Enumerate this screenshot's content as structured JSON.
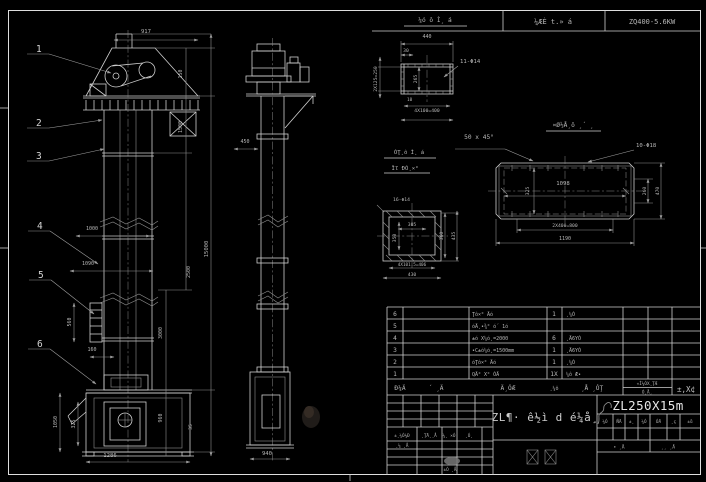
{
  "colors": {
    "background": "#000000",
    "line": "#cfcfcf",
    "dim_line": "#8f8f8f",
    "text": "#b6b6b6",
    "bright_text": "#e6e6e6"
  },
  "top_bar": {
    "process_cell": "¼ÆÈ t.» á",
    "model_cell": "ZQ400-5.6KW"
  },
  "front": {
    "balloons": [
      "1",
      "2",
      "3",
      "4",
      "5",
      "6"
    ],
    "dim": {
      "w917": "917",
      "h150": "150",
      "h1500": "1500",
      "h2500": "2500",
      "h3000": "3000",
      "h960": "960",
      "h35": "35",
      "overall": "15000",
      "w1000": "1000",
      "w1090": "1090",
      "ladder_h": "560",
      "ladder_w": "160",
      "boot_h1": "1050",
      "boot_h2": "325",
      "boot_w": "1286"
    }
  },
  "side": {
    "dim": {
      "w450": "450",
      "w940": "940"
    }
  },
  "det_a": {
    "title": "¼ó ô Ì¸ á",
    "w440": "440",
    "w30": "30",
    "left": "2X125=250",
    "inner": "265",
    "bottom": "4X100=400",
    "small": "10",
    "holes": "11-Φ14"
  },
  "note": {
    "chamfer": "50 x 45°"
  },
  "det_b": {
    "t1": "ÓŢ¸ô Ì¸ á",
    "t2": "Ïľ ĐÓ¸×°",
    "holes": "16-Φ14",
    "w305": "305",
    "h350": "350",
    "r360": "360",
    "r435": "435",
    "b406": "4X101.5=406",
    "b430": "430"
  },
  "det_c": {
    "title": "¤Ø½Å¸ô ¸´ ¸",
    "holes": "10-Φ18",
    "w1098": "1098",
    "l325": "325",
    "r260": "260",
    "r470": "470",
    "b800": "2X400=800",
    "b1190": "1190"
  },
  "bom": {
    "rows": [
      {
        "no": "6",
        "name": "Ţô×° Äó",
        "qty": "1",
        "material": "¸¼Ó"
      },
      {
        "no": "5",
        "name": "óÄ¸•¾° ó´ 1ó",
        "qty": "",
        "material": ""
      },
      {
        "no": "4",
        "name": "±ó X¼ó¸=2000",
        "qty": "6",
        "material": "¸Ä6YÓ"
      },
      {
        "no": "3",
        "name": "•C±ó¼ó¸=1500mm",
        "qty": "1",
        "material": "¸Ä6YÓ"
      },
      {
        "no": "2",
        "name": "óŢô×° Äó",
        "qty": "1",
        "material": "¸¼Ó"
      },
      {
        "no": "1",
        "name": "QÄ° X° ÓÄ",
        "qty": "1X",
        "material": "¼ô Æ•"
      }
    ],
    "header": {
      "no": "Đ¼Ä",
      "dwg": "´ ¸Ä",
      "name": "Ä¸ÓÆ",
      "qty": "¸¼ô",
      "material": "¸Å ¸ÓŢ",
      "note_small": "«Ì¼ÓX¸ŢÆ",
      "note_sub": "Ó¸Å¸",
      "note_big": "±,X¢"
    }
  },
  "tb": {
    "left": {
      "r1a": "±¸¼Ó¼Đ",
      "r1b": "¸ŢÄ¸¸Å",
      "r1c": "¼¸ ×Ó",
      "r1d": "¸Ó¸",
      "r2a": "¸¼ ¸Å",
      "r3a": "±Ó ¸Å"
    },
    "main_title": "ZL¶· ê½ì d é¼å¸",
    "model": "ZL250X15m",
    "rev_row": [
      "¼Ó",
      "ŇÄ",
      "±¸",
      "¼Ó",
      "ÓÄ",
      "¸ç",
      "±ů"
    ],
    "sheet_left": "• ¸Å",
    "sheet_right": "¸¸ ¸Å"
  }
}
